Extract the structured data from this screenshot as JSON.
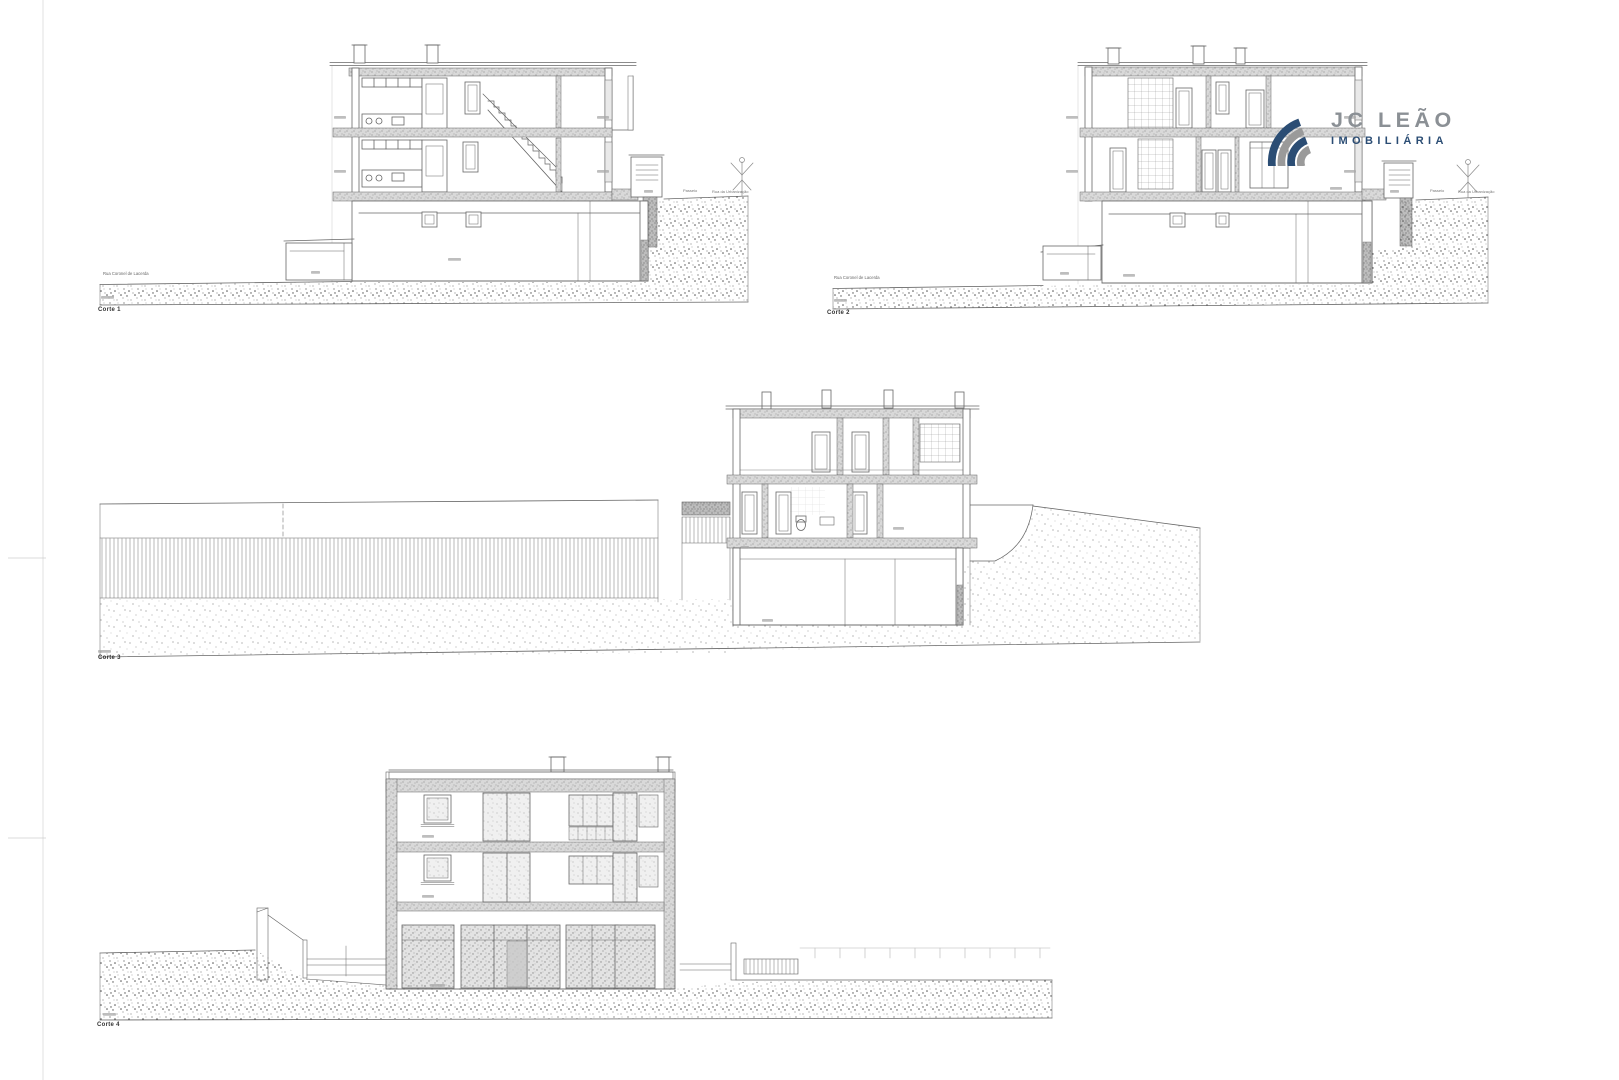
{
  "logo": {
    "name": "JC LEÃO",
    "tagline": "IMOBILIÁRIA",
    "icon": "wave-swoosh-icon",
    "colors": {
      "name_gray": "#8b9095",
      "tagline_navy": "#2b4d74",
      "swoosh_navy": "#2b4d74",
      "swoosh_gray": "#9a9a9a"
    }
  },
  "drawings": [
    {
      "id": "corte-1",
      "label": "Corte 1",
      "street_left": "Rua Coronel de Lacerda",
      "sidewalk_label": "Passeio",
      "street_right": "Rua da Urbanização"
    },
    {
      "id": "corte-2",
      "label": "Corte 2",
      "street_left": "Rua Coronel de Lacerda",
      "sidewalk_label": "Passeio",
      "street_right": "Rua da Urbanização"
    },
    {
      "id": "corte-3",
      "label": "Corte 3"
    },
    {
      "id": "corte-4",
      "label": "Corte 4"
    }
  ]
}
